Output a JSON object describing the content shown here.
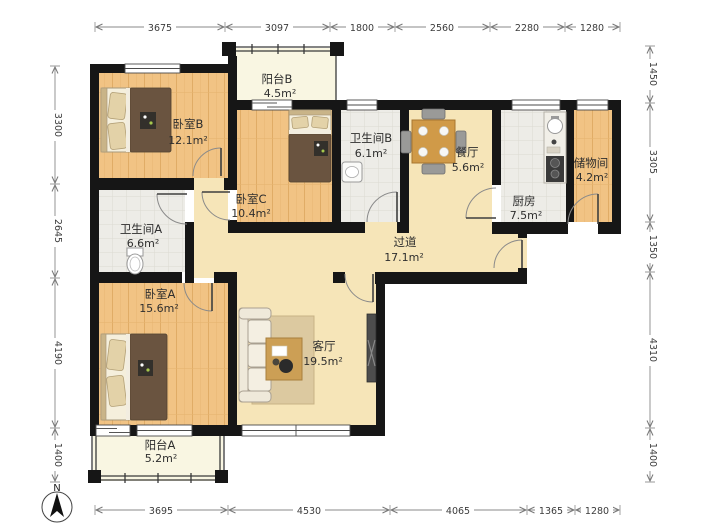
{
  "compass": {
    "label": "N"
  },
  "rooms": {
    "balconyB": {
      "name": "阳台B",
      "area": "4.5m²"
    },
    "bedroomB": {
      "name": "卧室B",
      "area": "12.1m²"
    },
    "bedroomC": {
      "name": "卧室C",
      "area": "10.4m²"
    },
    "bathroomB": {
      "name": "卫生间B",
      "area": "6.1m²"
    },
    "dining": {
      "name": "餐厅",
      "area": "5.6m²"
    },
    "kitchen": {
      "name": "厨房",
      "area": "7.5m²"
    },
    "storage": {
      "name": "储物间",
      "area": "4.2m²"
    },
    "bathroomA": {
      "name": "卫生间A",
      "area": "6.6m²"
    },
    "corridor": {
      "name": "过道",
      "area": "17.1m²"
    },
    "bedroomA": {
      "name": "卧室A",
      "area": "15.6m²"
    },
    "living": {
      "name": "客厅",
      "area": "19.5m²"
    },
    "balconyA": {
      "name": "阳台A",
      "area": "5.2m²"
    }
  },
  "dimensions": {
    "top": [
      "3675",
      "3097",
      "1800",
      "2560",
      "2280",
      "1280"
    ],
    "bottom": [
      "3695",
      "4530",
      "4065",
      "1365",
      "1280"
    ],
    "left": [
      "3300",
      "2645",
      "4190",
      "1400"
    ],
    "right": [
      "1450",
      "3305",
      "1350",
      "4310",
      "1400"
    ]
  },
  "colors": {
    "wall": "#161616",
    "wood_floor": "#F1C384",
    "tile_floor": "#EDECE7",
    "beige_floor": "#F6E5B8",
    "balcony_floor": "#F9F6E2",
    "duvet": "#6A5440"
  }
}
